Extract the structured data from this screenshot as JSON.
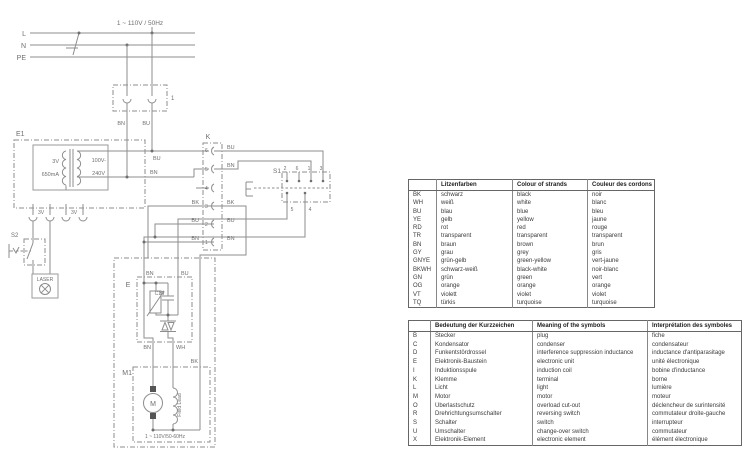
{
  "diagram": {
    "supply": "1 ~ 110V / 50Hz",
    "line_l": "L",
    "line_n": "N",
    "line_pe": "PE",
    "connector1": "1",
    "e1_label": "E1",
    "transformer": {
      "secondary_voltage": "3V",
      "secondary_current": "650mA",
      "primary_min": "100V-",
      "primary_max": "240V"
    },
    "plug_voltage_a": "3V",
    "plug_voltage_b": "3V",
    "s2_label": "S2",
    "laser_label": "LASER",
    "k_label": "K",
    "k_terminals": [
      "6",
      "5",
      "4",
      "3",
      "2",
      "1"
    ],
    "s1_label": "S1",
    "s1_top_terminals": [
      "2",
      "6",
      "1",
      "3"
    ],
    "s1_bottom_terminals": [
      "5",
      "4"
    ],
    "e_block_label": "E",
    "c1_label": "C1",
    "m1_label": "M1",
    "motor_label": "M",
    "field_label": "Field Lead",
    "motor_rating": "1 ~ 110V/50-60Hz",
    "colors": {
      "bn": "BN",
      "bu": "BU",
      "bk": "BK",
      "wh": "WH"
    }
  },
  "tables": {
    "strand_colors": {
      "columns": [
        "",
        "Litzenfarben",
        "Colour of strands",
        "Couleur des cordons"
      ],
      "rows": [
        [
          "BK",
          "schwarz",
          "black",
          "noir"
        ],
        [
          "WH",
          "weiß",
          "white",
          "blanc"
        ],
        [
          "BU",
          "blau",
          "blue",
          "bleu"
        ],
        [
          "YE",
          "gelb",
          "yellow",
          "jaune"
        ],
        [
          "RD",
          "rot",
          "red",
          "rouge"
        ],
        [
          "TR",
          "transparent",
          "transparent",
          "transparent"
        ],
        [
          "BN",
          "braun",
          "brown",
          "brun"
        ],
        [
          "GY",
          "grau",
          "grey",
          "gris"
        ],
        [
          "GNYE",
          "grün-gelb",
          "green-yellow",
          "vert-jaune"
        ],
        [
          "BKWH",
          "schwarz-weiß",
          "black-white",
          "noir-blanc"
        ],
        [
          "GN",
          "grün",
          "green",
          "vert"
        ],
        [
          "OG",
          "orange",
          "orange",
          "orange"
        ],
        [
          "VT",
          "violett",
          "violet",
          "violet"
        ],
        [
          "TQ",
          "türkis",
          "turquoise",
          "turquoise"
        ]
      ]
    },
    "symbols": {
      "columns": [
        "",
        "Bedeutung der Kurzzeichen",
        "Meaning of the symbols",
        "Interprétation des symboles"
      ],
      "rows": [
        [
          "B",
          "Stecker",
          "plug",
          "fiche"
        ],
        [
          "C",
          "Kondensator",
          "condenser",
          "condensateur"
        ],
        [
          "D",
          "Funkentstördrossel",
          "interference suppression inductance",
          "inductance d'antiparasitage"
        ],
        [
          "E",
          "Elektronik-Baustein",
          "electronic unit",
          "unité électronique"
        ],
        [
          "I",
          "Induktionsspule",
          "induction coil",
          "bobine d'inductance"
        ],
        [
          "K",
          "Klemme",
          "terminal",
          "borne"
        ],
        [
          "L",
          "Licht",
          "light",
          "lumière"
        ],
        [
          "M",
          "Motor",
          "motor",
          "moteur"
        ],
        [
          "O",
          "Überlastschutz",
          "overload cut-out",
          "déclencheur de surintensité"
        ],
        [
          "R",
          "Drehrichtungsumschalter",
          "reversing switch",
          "commutateur droite-gauche"
        ],
        [
          "S",
          "Schalter",
          "switch",
          "interrupteur"
        ],
        [
          "U",
          "Umschalter",
          "change-over switch",
          "commutateur"
        ],
        [
          "X",
          "Elektronik-Element",
          "electronic element",
          "élément électronique"
        ]
      ]
    }
  }
}
